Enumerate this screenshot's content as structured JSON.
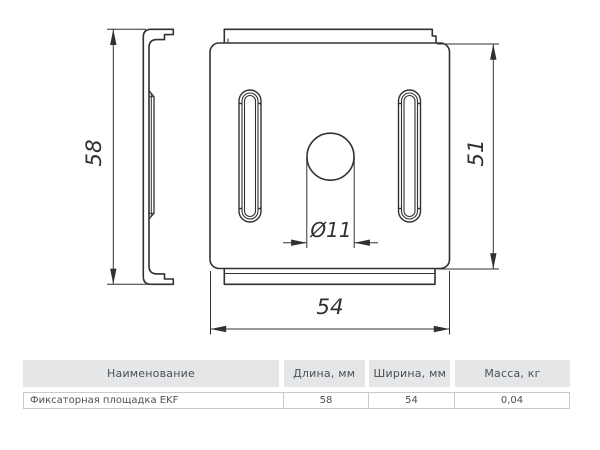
{
  "drawing": {
    "dim_side_height": "58",
    "dim_plate_height": "51",
    "dim_plate_width": "54",
    "dim_hole_diameter": "Ø11"
  },
  "table": {
    "headers": [
      "Наименование",
      "Длина, мм",
      "Ширина, мм",
      "Масса, кг"
    ],
    "rows": [
      [
        "Фиксаторная площадка EKF",
        "58",
        "54",
        "0,04"
      ]
    ]
  },
  "colors": {
    "line": "#2f3235",
    "table_header_bg": "#e4e6e8",
    "table_border": "#c7cacd",
    "table_text": "#4b5055"
  }
}
